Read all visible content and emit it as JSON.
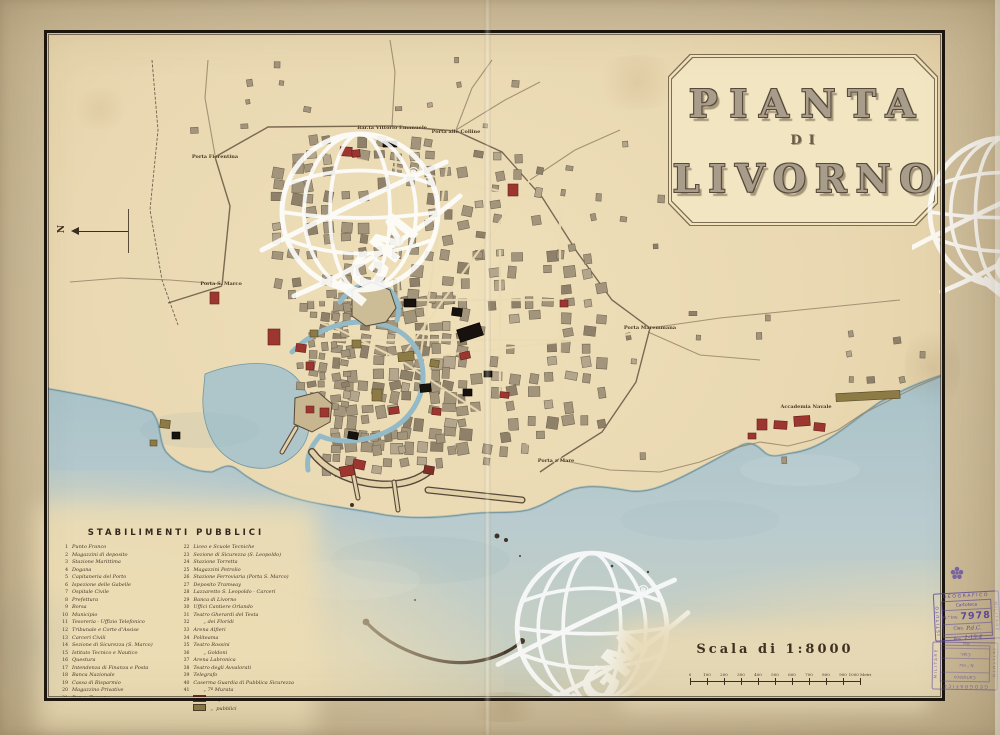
{
  "page": {
    "title": "Pianta di Livorno"
  },
  "cartouche": {
    "line1": "PIANTA",
    "line2": "DI",
    "line3": "LIVORNO"
  },
  "legend": {
    "title": "STABILIMENTI  PUBBLICI",
    "col_left": [
      {
        "n": "1",
        "t": "Punto Franco"
      },
      {
        "n": "2",
        "t": "Magazzini di deposito"
      },
      {
        "n": "3",
        "t": "Stazione Marittima"
      },
      {
        "n": "4",
        "t": "Dogana"
      },
      {
        "n": "5",
        "t": "Capitaneria del Porto"
      },
      {
        "n": "6",
        "t": "Ispezione delle Gabelle"
      },
      {
        "n": "7",
        "t": "Ospitale Civile"
      },
      {
        "n": "8",
        "t": "Prefettura"
      },
      {
        "n": "9",
        "t": "Borsa"
      },
      {
        "n": "10",
        "t": "Municipio"
      },
      {
        "n": "11",
        "t": "Tesoreria - Uffizio Telefonico"
      },
      {
        "n": "12",
        "t": "Tribunale e Corte d'Assise"
      },
      {
        "n": "13",
        "t": "Carceri Civili"
      },
      {
        "n": "14",
        "t": "Sezione di Sicurezza (S. Marco)"
      },
      {
        "n": "15",
        "t": "Istituto Tecnico e Nautico"
      },
      {
        "n": "16",
        "t": "Questura"
      },
      {
        "n": "17",
        "t": "Intendenza di Finanza e Posta"
      },
      {
        "n": "18",
        "t": "Banca Nazionale"
      },
      {
        "n": "19",
        "t": "Cassa di Risparmio"
      },
      {
        "n": "20",
        "t": "Magazzino Privative"
      },
      {
        "n": "21",
        "t": "Banca Toscana"
      }
    ],
    "col_right": [
      {
        "n": "22",
        "t": "Liceo e Scuole Tecniche"
      },
      {
        "n": "23",
        "t": "Sezione di Sicurezza (S. Leopoldo)"
      },
      {
        "n": "24",
        "t": "Stazione Torretta"
      },
      {
        "n": "25",
        "t": "Magazzini Petrolio"
      },
      {
        "n": "26",
        "t": "Stazione Ferroviaria (Porta S. Marco)"
      },
      {
        "n": "27",
        "t": "Deposito Tramway"
      },
      {
        "n": "28",
        "t": "Lazzaretto S. Leopoldo - Carceri"
      },
      {
        "n": "29",
        "t": "Banca di Livorno"
      },
      {
        "n": "30",
        "t": "Uffici Cantiere Orlando"
      },
      {
        "n": "31",
        "t": "Teatro Gherardi del Testa"
      },
      {
        "n": "32",
        "t": "„ dei Floridi",
        "i": 1
      },
      {
        "n": "33",
        "t": "Arena Alfieri"
      },
      {
        "n": "34",
        "t": "Politeama"
      },
      {
        "n": "35",
        "t": "Teatro Rossini"
      },
      {
        "n": "36",
        "t": "„ Goldoni",
        "i": 1
      },
      {
        "n": "37",
        "t": "Arena Labronica"
      },
      {
        "n": "38",
        "t": "Teatro degli Avvalorati"
      },
      {
        "n": "39",
        "t": "Telegrafo"
      },
      {
        "n": "40",
        "t": "Caserma Guardia di Pubblica Sicurezza"
      },
      {
        "n": "41",
        "t": "„ 7ª Murata",
        "i": 1
      }
    ],
    "swatches": [
      {
        "color": "#9e3630",
        "label": "Edifizi militari"
      },
      {
        "color": "#8d7b46",
        "label": "„  pubblici"
      }
    ]
  },
  "scale": {
    "caption": "Scala di 1:8000",
    "ticks": [
      "0",
      "100",
      "200",
      "300",
      "400",
      "500",
      "600",
      "700",
      "800",
      "900",
      "1000"
    ],
    "unit": "Metri"
  },
  "compass": {
    "label": "N"
  },
  "watermark": {
    "text": "IGM",
    "registered": "®"
  },
  "stamps": {
    "border_top": "GEOGRAFICO",
    "border_left": "ISTITUTO",
    "border_right": "MILITARE",
    "row1": "Cartoteca",
    "row2_label": "N.° Inv.",
    "row2_value": "7978",
    "row3_label": "Clas.",
    "row3_value": "P.d.C.",
    "row4_label": "Pos.",
    "row4_value": "1-19-4"
  },
  "map": {
    "labels": [
      {
        "text": "Porta Fiorentina",
        "x": 215,
        "y": 157
      },
      {
        "text": "Bar.ta Vittorio Emanuele",
        "x": 392,
        "y": 128
      },
      {
        "text": "Porta alle Colline",
        "x": 456,
        "y": 132
      },
      {
        "text": "Porta S. Marco",
        "x": 221,
        "y": 284
      },
      {
        "text": "Porta Maremmana",
        "x": 650,
        "y": 328
      },
      {
        "text": "Porta a Mare",
        "x": 556,
        "y": 461
      },
      {
        "text": "Accademia Navale",
        "x": 806,
        "y": 407
      }
    ]
  },
  "colors": {
    "paper": "#e9d8b1",
    "margin": "#d2c19e",
    "sea": "#b3c8cc",
    "military": "#9e3630",
    "public_buildings": "#8d7b46",
    "block": "#a2957c",
    "block_dark": "#8f8169",
    "block_light": "#b3a68c",
    "canal": "#93bac6",
    "stamp_ink": "#5f4ba0",
    "ink": "#3a2e20"
  }
}
